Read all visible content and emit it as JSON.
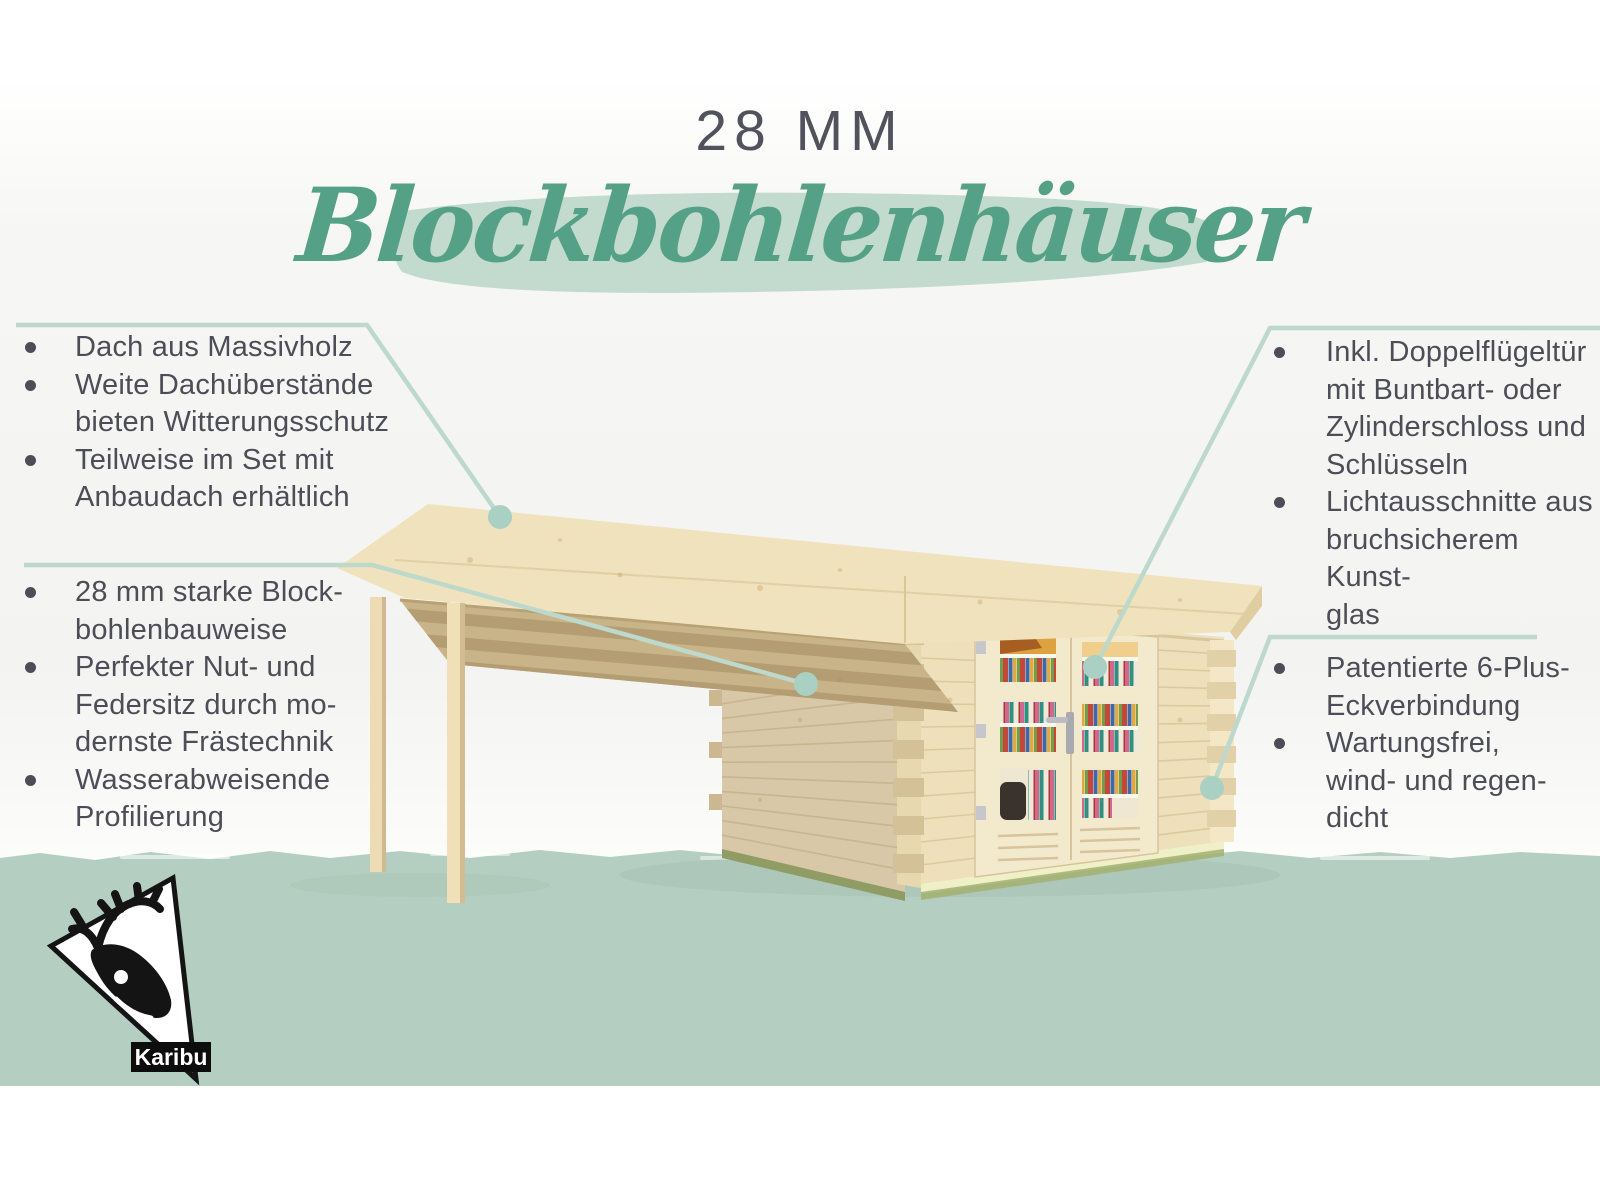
{
  "title": {
    "kicker": "28 MM",
    "main": "Blockbohlenhäuser"
  },
  "callouts": {
    "top_left": {
      "items": [
        {
          "lines": [
            "Dach aus Massivholz"
          ]
        },
        {
          "lines": [
            "Weite Dachüberstände",
            "bieten Witterungsschutz"
          ]
        },
        {
          "lines": [
            "Teilweise im Set mit",
            "Anbaudach erhältlich"
          ]
        }
      ]
    },
    "mid_left": {
      "items": [
        {
          "lines": [
            "28 mm starke Block-",
            "bohlenbauweise"
          ]
        },
        {
          "lines": [
            "Perfekter Nut- und",
            "Federsitz durch mo-",
            "dernste Frästechnik"
          ]
        },
        {
          "lines": [
            "Wasserabweisende",
            "Profilierung"
          ]
        }
      ]
    },
    "top_right": {
      "items": [
        {
          "lines": [
            "Inkl. Doppelflügeltür",
            "mit Buntbart- oder",
            "Zylinderschloss und",
            "Schlüsseln"
          ]
        },
        {
          "lines": [
            "Lichtausschnitte aus",
            "bruchsicherem Kunst-",
            "glas"
          ]
        }
      ]
    },
    "bottom_right": {
      "items": [
        {
          "lines": [
            "Patentierte 6-Plus-",
            "Eckverbindung"
          ]
        },
        {
          "lines": [
            "Wartungsfrei,",
            "wind- und regen-",
            "dicht"
          ]
        }
      ]
    }
  },
  "logo": {
    "label": "Karibu",
    "icon": "deer-icon"
  },
  "colors": {
    "accent_green": "#55a187",
    "brush_green": "#c3dbce",
    "band_green": "#b4cfc2",
    "leader_line": "#bcd9cb",
    "leader_dot": "#a9d0c3",
    "text": "#4d4d57",
    "wood_light": "#f0e2bd",
    "wood_front": "#eee0bb",
    "wood_shadow": "#d9c8a7"
  }
}
